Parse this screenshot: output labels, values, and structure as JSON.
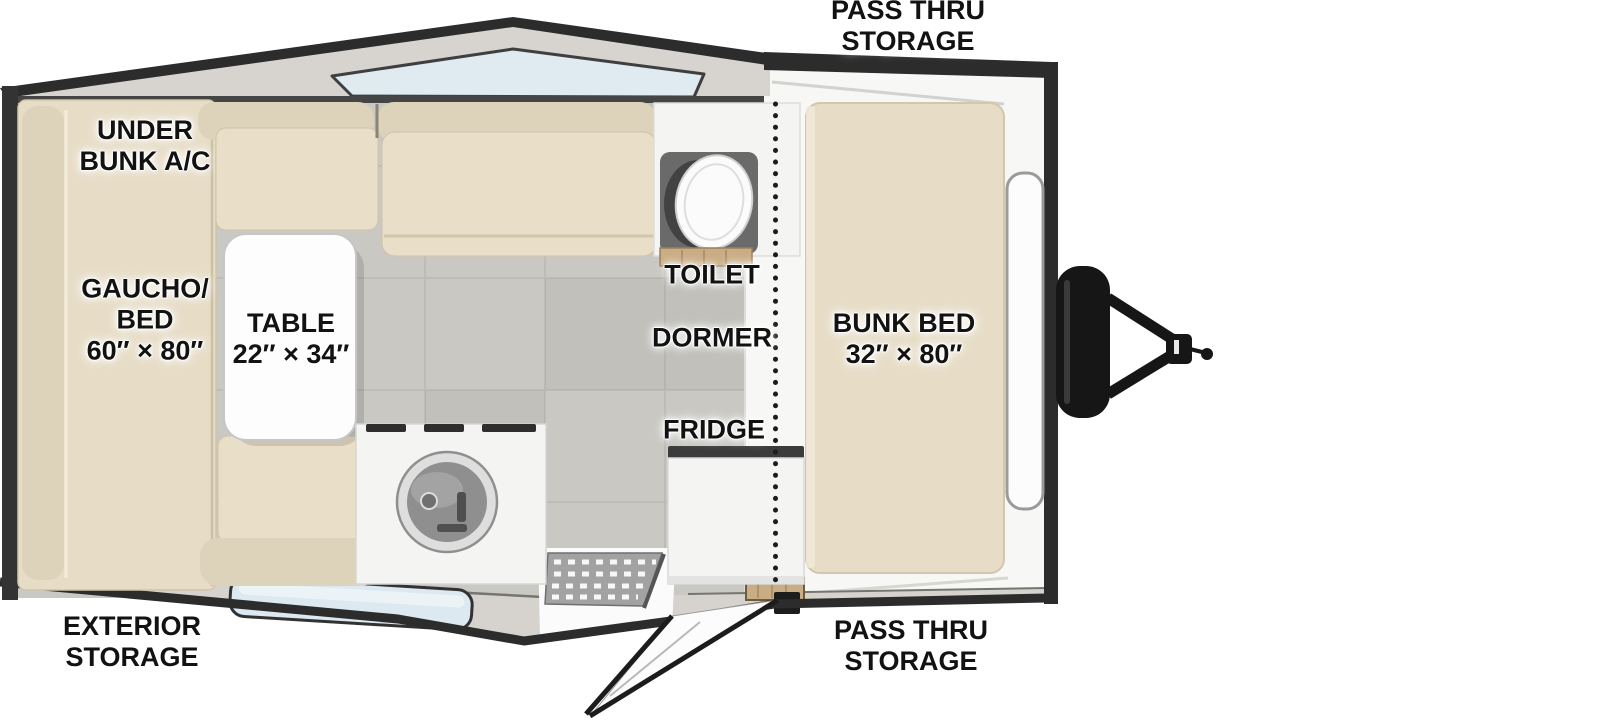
{
  "figure": "travel-trailer-floorplan-top-view",
  "labels": {
    "pass_thru_top": {
      "line1": "PASS THRU",
      "line2": "STORAGE"
    },
    "under_bunk_ac": {
      "line1": "UNDER",
      "line2": "BUNK A/C"
    },
    "gaucho_bed": {
      "line1": "GAUCHO/",
      "line2": "BED",
      "line3": "60″ × 80″"
    },
    "dinette_table": {
      "line1": "TABLE",
      "line2": "22″ × 34″"
    },
    "toilet": {
      "line1": "TOILET"
    },
    "dormer": {
      "line1": "DORMER"
    },
    "fridge": {
      "line1": "FRIDGE"
    },
    "bunk_bed": {
      "line1": "BUNK BED",
      "line2": "32″ × 80″"
    },
    "exterior_storage": {
      "line1": "EXTERIOR",
      "line2": "STORAGE"
    },
    "pass_thru_bottom": {
      "line1": "PASS THRU",
      "line2": "STORAGE"
    }
  },
  "colors": {
    "wall_dark": "#2c2c2c",
    "roof_surface": "#d7d4cf",
    "band_surface": "#d6d3ce",
    "cushion": "#e9dfc9",
    "cushion_shade": "#ddd2ba",
    "bed": "#e7ddc7",
    "floor": "#c9c8c3",
    "glass": "#dce9f0",
    "fixture_white": "#f4f4f2",
    "nose_white": "#f7f7f5",
    "wood": "#c9ad85",
    "mat_gray": "#a2a2a2",
    "hitch_black": "#161616"
  }
}
